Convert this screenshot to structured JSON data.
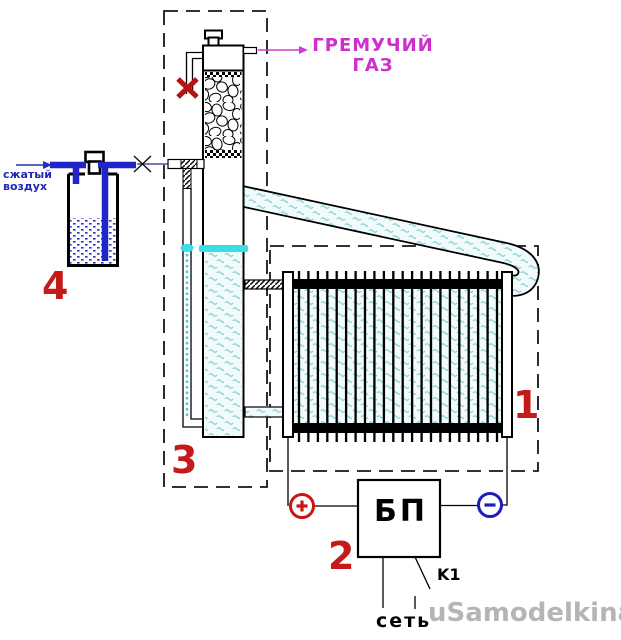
{
  "diagram": {
    "air_inlet": {
      "label_line1": "сжатый",
      "label_line2": "воздух",
      "color": "#2028b8"
    },
    "gas_outlet": {
      "label_line1": "ГРЕМУЧИЙ",
      "label_line2": "ГАЗ",
      "color": "#cc2fcc"
    },
    "part_labels": {
      "electrolyzer": "1",
      "power_supply": "2",
      "bubbler_column": "3",
      "water_tank": "4",
      "color": "#c41a1a"
    },
    "power_supply": {
      "box_text": "БП",
      "relay_label": "K1",
      "mains_label": "сеть",
      "plus_color": "#cc1414",
      "minus_color": "#1d1dbb"
    },
    "watermark": {
      "text": "uSamodelkina.ru",
      "color": "#b5b5b5"
    },
    "colors": {
      "pipe_blue": "#1f25c8",
      "water_level_cyan": "#38dfe6",
      "wave_teal": "#7fcfcf",
      "closed_valve_red": "#b51212"
    }
  }
}
